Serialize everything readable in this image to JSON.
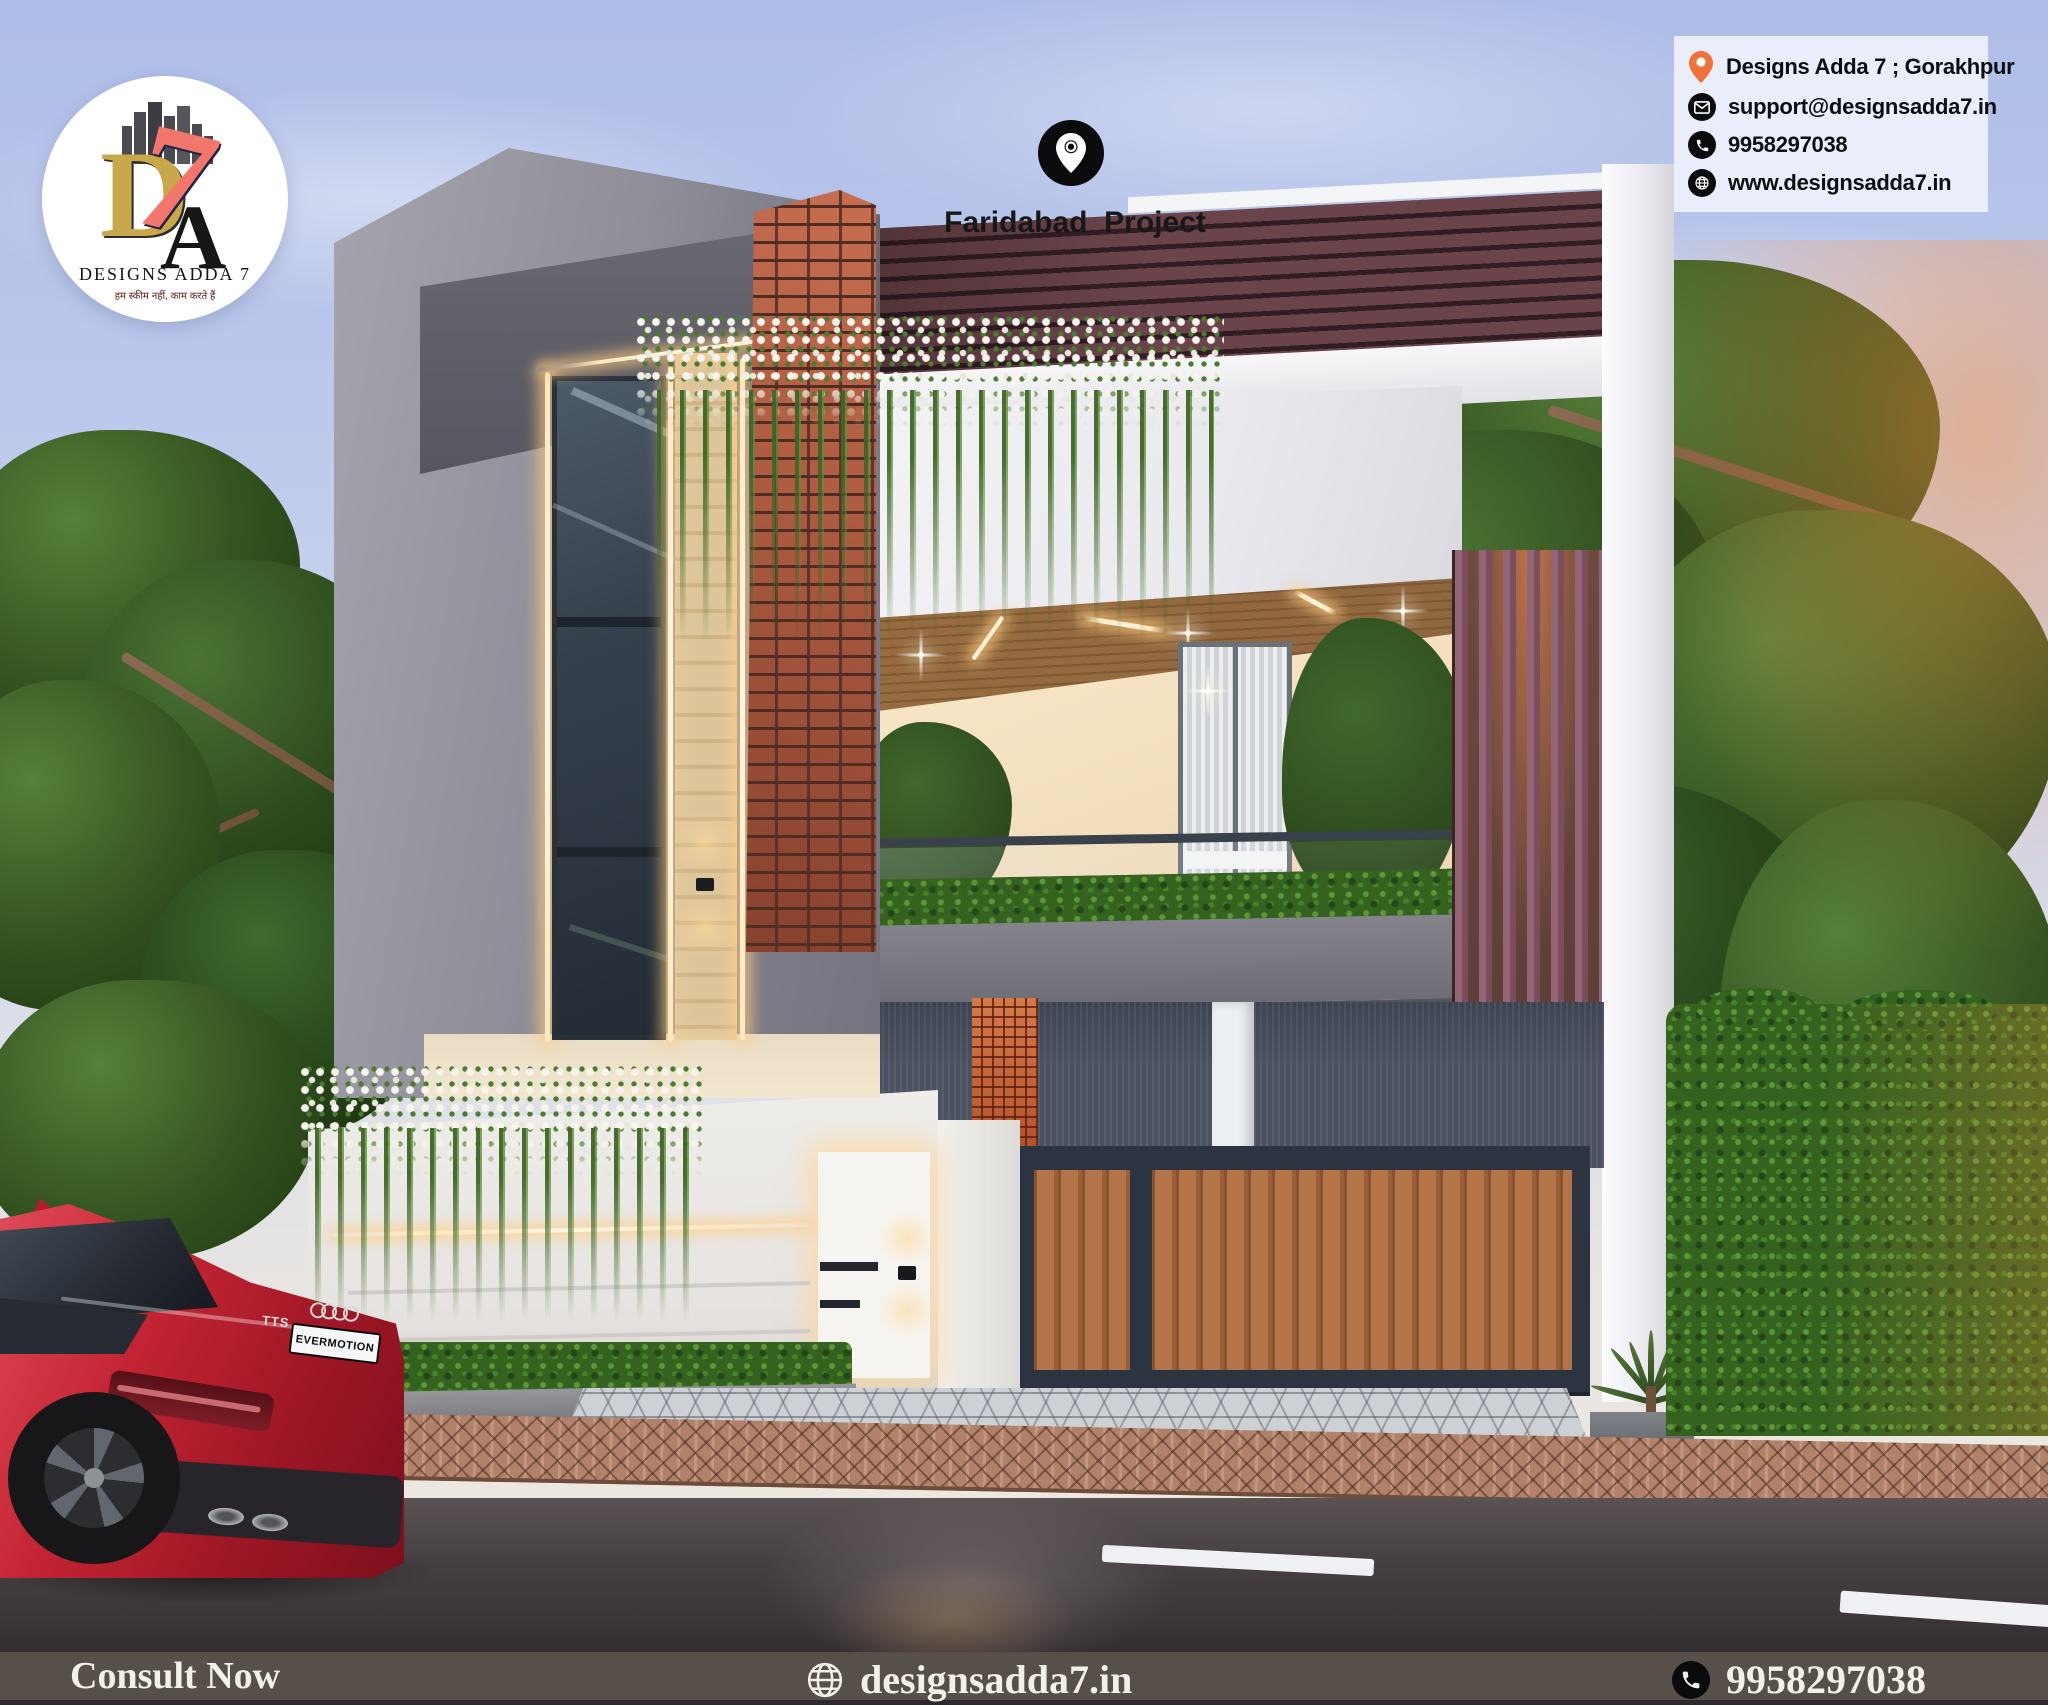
{
  "page": {
    "width": 2048,
    "height": 1705
  },
  "brand": {
    "name": "DESIGNS ADDA 7",
    "tagline_hi": "हम स्कीम नहीं, काम करते हैं",
    "monogram": {
      "d": "D",
      "a": "A",
      "seven": "7"
    }
  },
  "project_label": {
    "text": "Faridabad  Project"
  },
  "contact_card": {
    "rows": [
      {
        "icon": "location-pin-icon",
        "text": "Designs Adda 7 ; Gorakhpur"
      },
      {
        "icon": "email-icon",
        "text": "support@designsadda7.in"
      },
      {
        "icon": "phone-icon",
        "text": "9958297038"
      },
      {
        "icon": "globe-icon",
        "text": "www.designsadda7.in"
      }
    ]
  },
  "footer": {
    "cta": "Consult Now",
    "website": "designsadda7.in",
    "phone": "9958297038"
  },
  "scene": {
    "car_plate": "EVERMOTION",
    "car_badge": "TTS"
  },
  "colors": {
    "pin_orange": "#f0713a",
    "footer_bar": "#57504a",
    "car_red": "#c22031",
    "led_warm": "#ffdf9e",
    "brick": "#b0563c",
    "pergola_maroon": "#6b444b",
    "louver_mauve": "#8d5e6b",
    "hedge_green": "#35621f"
  }
}
